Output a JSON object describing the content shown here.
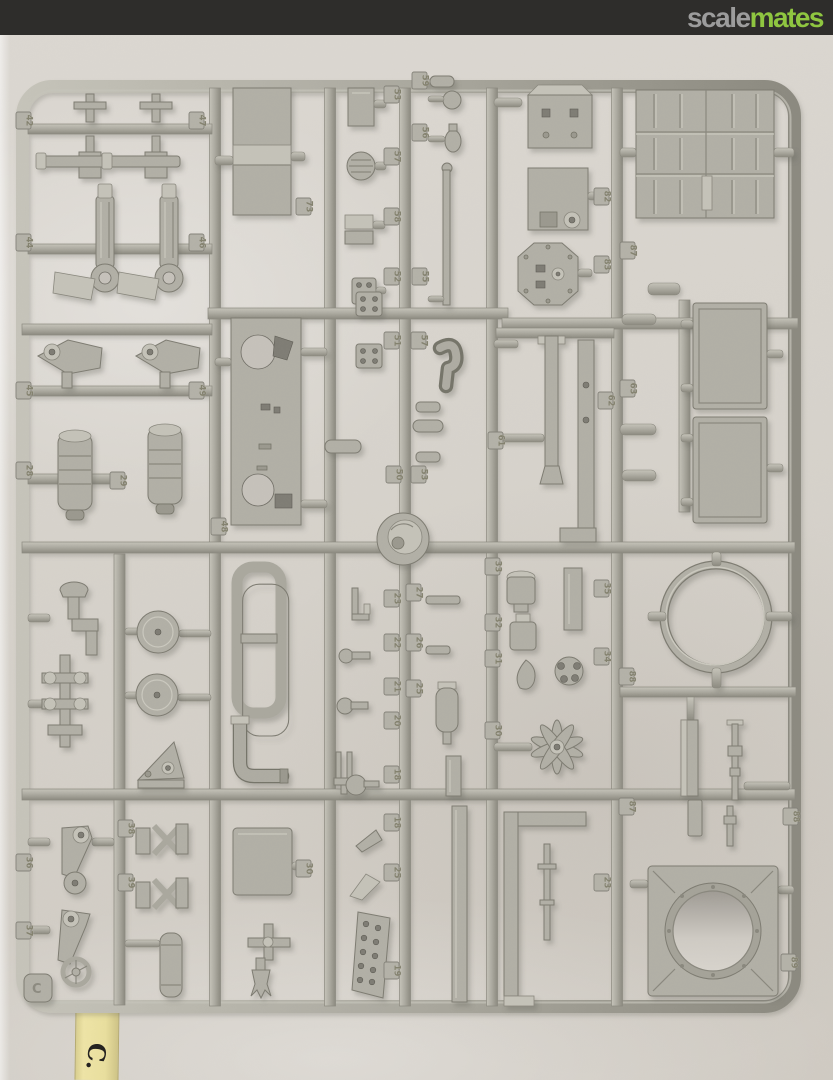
{
  "header": {
    "bar_color": "#2e2d2b",
    "logo_scale": "scale",
    "logo_mates": "mates",
    "logo_scale_color": "#9c9c9c",
    "logo_mates_color": "#8fc640"
  },
  "photo": {
    "subject": "grey styrene model kit parts sprue (frame C) photographed on a light background",
    "tape_label": "C.",
    "molded_corner_letter": "C",
    "tape_color": "#e9df9e",
    "background_color": "#d7d3cc",
    "plastic_color": "#b2b0a6"
  },
  "sprue": {
    "tags": [
      {
        "x": 16,
        "y": 112,
        "n": "42"
      },
      {
        "x": 189,
        "y": 112,
        "n": "47"
      },
      {
        "x": 16,
        "y": 234,
        "n": "44"
      },
      {
        "x": 189,
        "y": 234,
        "n": "46"
      },
      {
        "x": 296,
        "y": 198,
        "n": "73"
      },
      {
        "x": 384,
        "y": 86,
        "n": "53"
      },
      {
        "x": 384,
        "y": 148,
        "n": "57"
      },
      {
        "x": 384,
        "y": 208,
        "n": "58"
      },
      {
        "x": 384,
        "y": 268,
        "n": "52"
      },
      {
        "x": 412,
        "y": 72,
        "n": "59"
      },
      {
        "x": 412,
        "y": 124,
        "n": "56"
      },
      {
        "x": 412,
        "y": 268,
        "n": "55"
      },
      {
        "x": 594,
        "y": 188,
        "n": "82"
      },
      {
        "x": 594,
        "y": 256,
        "n": "83"
      },
      {
        "x": 620,
        "y": 242,
        "n": "87"
      },
      {
        "x": 16,
        "y": 382,
        "n": "45"
      },
      {
        "x": 189,
        "y": 382,
        "n": "49"
      },
      {
        "x": 16,
        "y": 462,
        "n": "28"
      },
      {
        "x": 110,
        "y": 472,
        "n": "29"
      },
      {
        "x": 211,
        "y": 518,
        "n": "48"
      },
      {
        "x": 384,
        "y": 332,
        "n": "51"
      },
      {
        "x": 411,
        "y": 332,
        "n": "57"
      },
      {
        "x": 386,
        "y": 466,
        "n": "50"
      },
      {
        "x": 411,
        "y": 466,
        "n": "53"
      },
      {
        "x": 488,
        "y": 432,
        "n": "61"
      },
      {
        "x": 598,
        "y": 392,
        "n": "62"
      },
      {
        "x": 620,
        "y": 380,
        "n": "63"
      },
      {
        "x": 384,
        "y": 590,
        "n": "23"
      },
      {
        "x": 384,
        "y": 634,
        "n": "22"
      },
      {
        "x": 384,
        "y": 678,
        "n": "21"
      },
      {
        "x": 384,
        "y": 712,
        "n": "20"
      },
      {
        "x": 384,
        "y": 766,
        "n": "18"
      },
      {
        "x": 406,
        "y": 584,
        "n": "27"
      },
      {
        "x": 406,
        "y": 634,
        "n": "26"
      },
      {
        "x": 406,
        "y": 680,
        "n": "25"
      },
      {
        "x": 485,
        "y": 558,
        "n": "33"
      },
      {
        "x": 485,
        "y": 614,
        "n": "32"
      },
      {
        "x": 485,
        "y": 650,
        "n": "31"
      },
      {
        "x": 485,
        "y": 722,
        "n": "30"
      },
      {
        "x": 594,
        "y": 580,
        "n": "35"
      },
      {
        "x": 594,
        "y": 648,
        "n": "34"
      },
      {
        "x": 619,
        "y": 668,
        "n": "88"
      },
      {
        "x": 384,
        "y": 814,
        "n": "18"
      },
      {
        "x": 384,
        "y": 864,
        "n": "25"
      },
      {
        "x": 384,
        "y": 962,
        "n": "19"
      },
      {
        "x": 296,
        "y": 860,
        "n": "30"
      },
      {
        "x": 118,
        "y": 820,
        "n": "38"
      },
      {
        "x": 16,
        "y": 854,
        "n": "36"
      },
      {
        "x": 118,
        "y": 874,
        "n": "39"
      },
      {
        "x": 16,
        "y": 922,
        "n": "37"
      },
      {
        "x": 619,
        "y": 798,
        "n": "87"
      },
      {
        "x": 783,
        "y": 808,
        "n": "88"
      },
      {
        "x": 781,
        "y": 954,
        "n": "89"
      },
      {
        "x": 594,
        "y": 874,
        "n": "23"
      }
    ]
  }
}
